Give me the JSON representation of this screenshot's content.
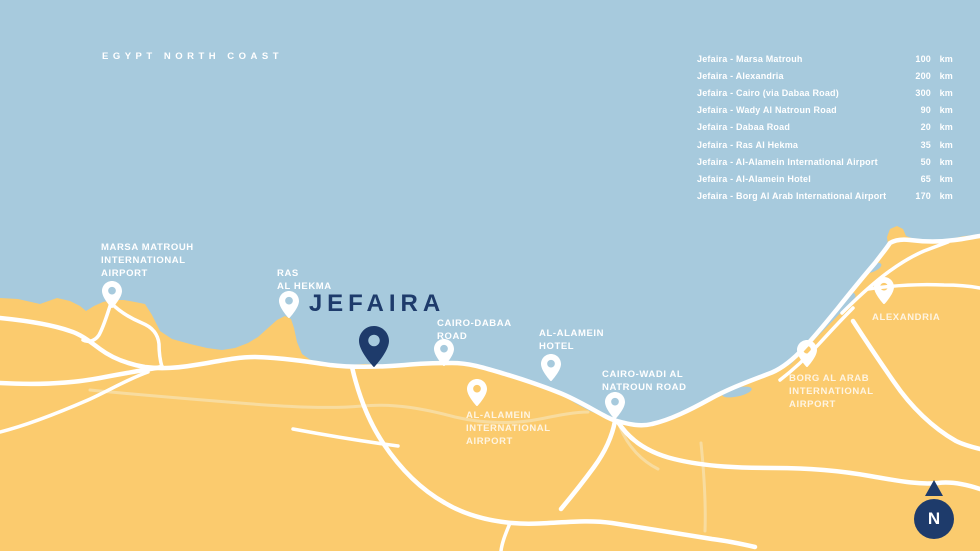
{
  "map": {
    "region_label": "EGYPT NORTH COAST",
    "title_marker": "JEFAIRA",
    "compass_label": "N",
    "colors": {
      "sea": "#a7cadd",
      "land": "#fbcb6e",
      "road": "#ffffff",
      "road_faint": "#f8dc9f",
      "navy": "#1e3b6b",
      "label": "#ffffff"
    },
    "markers": [
      {
        "id": "marsa-matrouh-airport",
        "lines": [
          "MARSA MATROUH",
          "INTERNATIONAL",
          "AIRPORT"
        ],
        "muted": false,
        "label_pos": {
          "x": 101,
          "y": 241
        },
        "pin": {
          "x": 112,
          "y": 308,
          "style": "white",
          "large": false
        }
      },
      {
        "id": "ras-al-hekma",
        "lines": [
          "RAS",
          "AL HEKMA"
        ],
        "muted": false,
        "label_pos": {
          "x": 277,
          "y": 267
        },
        "pin": {
          "x": 289,
          "y": 318,
          "style": "white",
          "large": false
        }
      },
      {
        "id": "jefaira",
        "lines": [],
        "muted": false,
        "pin": {
          "x": 374,
          "y": 367,
          "style": "navy",
          "large": true
        }
      },
      {
        "id": "cairo-dabaa-road",
        "lines": [
          "CAIRO-DABAA",
          "ROAD"
        ],
        "muted": false,
        "label_pos": {
          "x": 437,
          "y": 317
        },
        "pin": {
          "x": 444,
          "y": 366,
          "style": "white",
          "large": false
        }
      },
      {
        "id": "al-alamein-hotel",
        "lines": [
          "AL-ALAMEIN",
          "HOTEL"
        ],
        "muted": false,
        "label_pos": {
          "x": 539,
          "y": 327
        },
        "pin": {
          "x": 551,
          "y": 381,
          "style": "white",
          "large": false
        }
      },
      {
        "id": "al-alamein-international-airport",
        "lines": [
          "AL-ALAMEIN",
          "INTERNATIONAL",
          "AIRPORT"
        ],
        "muted": true,
        "label_pos": {
          "x": 466,
          "y": 409
        },
        "pin": {
          "x": 477,
          "y": 406,
          "style": "white",
          "large": false
        }
      },
      {
        "id": "cairo-wadi-al-natroun-road",
        "lines": [
          "CAIRO-WADI AL",
          "NATROUN ROAD"
        ],
        "muted": false,
        "label_pos": {
          "x": 602,
          "y": 368
        },
        "pin": {
          "x": 615,
          "y": 419,
          "style": "white",
          "large": false
        }
      },
      {
        "id": "alexandria",
        "lines": [
          "ALEXANDRIA"
        ],
        "muted": true,
        "label_pos": {
          "x": 872,
          "y": 311
        },
        "pin": {
          "x": 884,
          "y": 304,
          "style": "white",
          "large": false
        }
      },
      {
        "id": "borg-al-arab-international-airport",
        "lines": [
          "BORG AL ARAB",
          "INTERNATIONAL",
          "AIRPORT"
        ],
        "muted": true,
        "label_pos": {
          "x": 789,
          "y": 372
        },
        "pin": {
          "x": 807,
          "y": 367,
          "style": "white",
          "large": false
        }
      }
    ]
  },
  "distance_table": {
    "rows": [
      {
        "route": "Jefaira - Marsa Matrouh",
        "value": "100",
        "unit": "km"
      },
      {
        "route": "Jefaira - Alexandria",
        "value": "200",
        "unit": "km"
      },
      {
        "route": "Jefaira - Cairo (via Dabaa Road)",
        "value": "300",
        "unit": "km"
      },
      {
        "route": "Jefaira - Wady Al Natroun Road",
        "value": "90",
        "unit": "km"
      },
      {
        "route": "Jefaira - Dabaa Road",
        "value": "20",
        "unit": "km"
      },
      {
        "route": "Jefaira - Ras Al Hekma",
        "value": "35",
        "unit": "km"
      },
      {
        "route": "Jefaira - Al-Alamein International Airport",
        "value": "50",
        "unit": "km"
      },
      {
        "route": "Jefaira - Al-Alamein Hotel",
        "value": "65",
        "unit": "km"
      },
      {
        "route": "Jefaira - Borg Al Arab International Airport",
        "value": "170",
        "unit": "km"
      }
    ]
  }
}
